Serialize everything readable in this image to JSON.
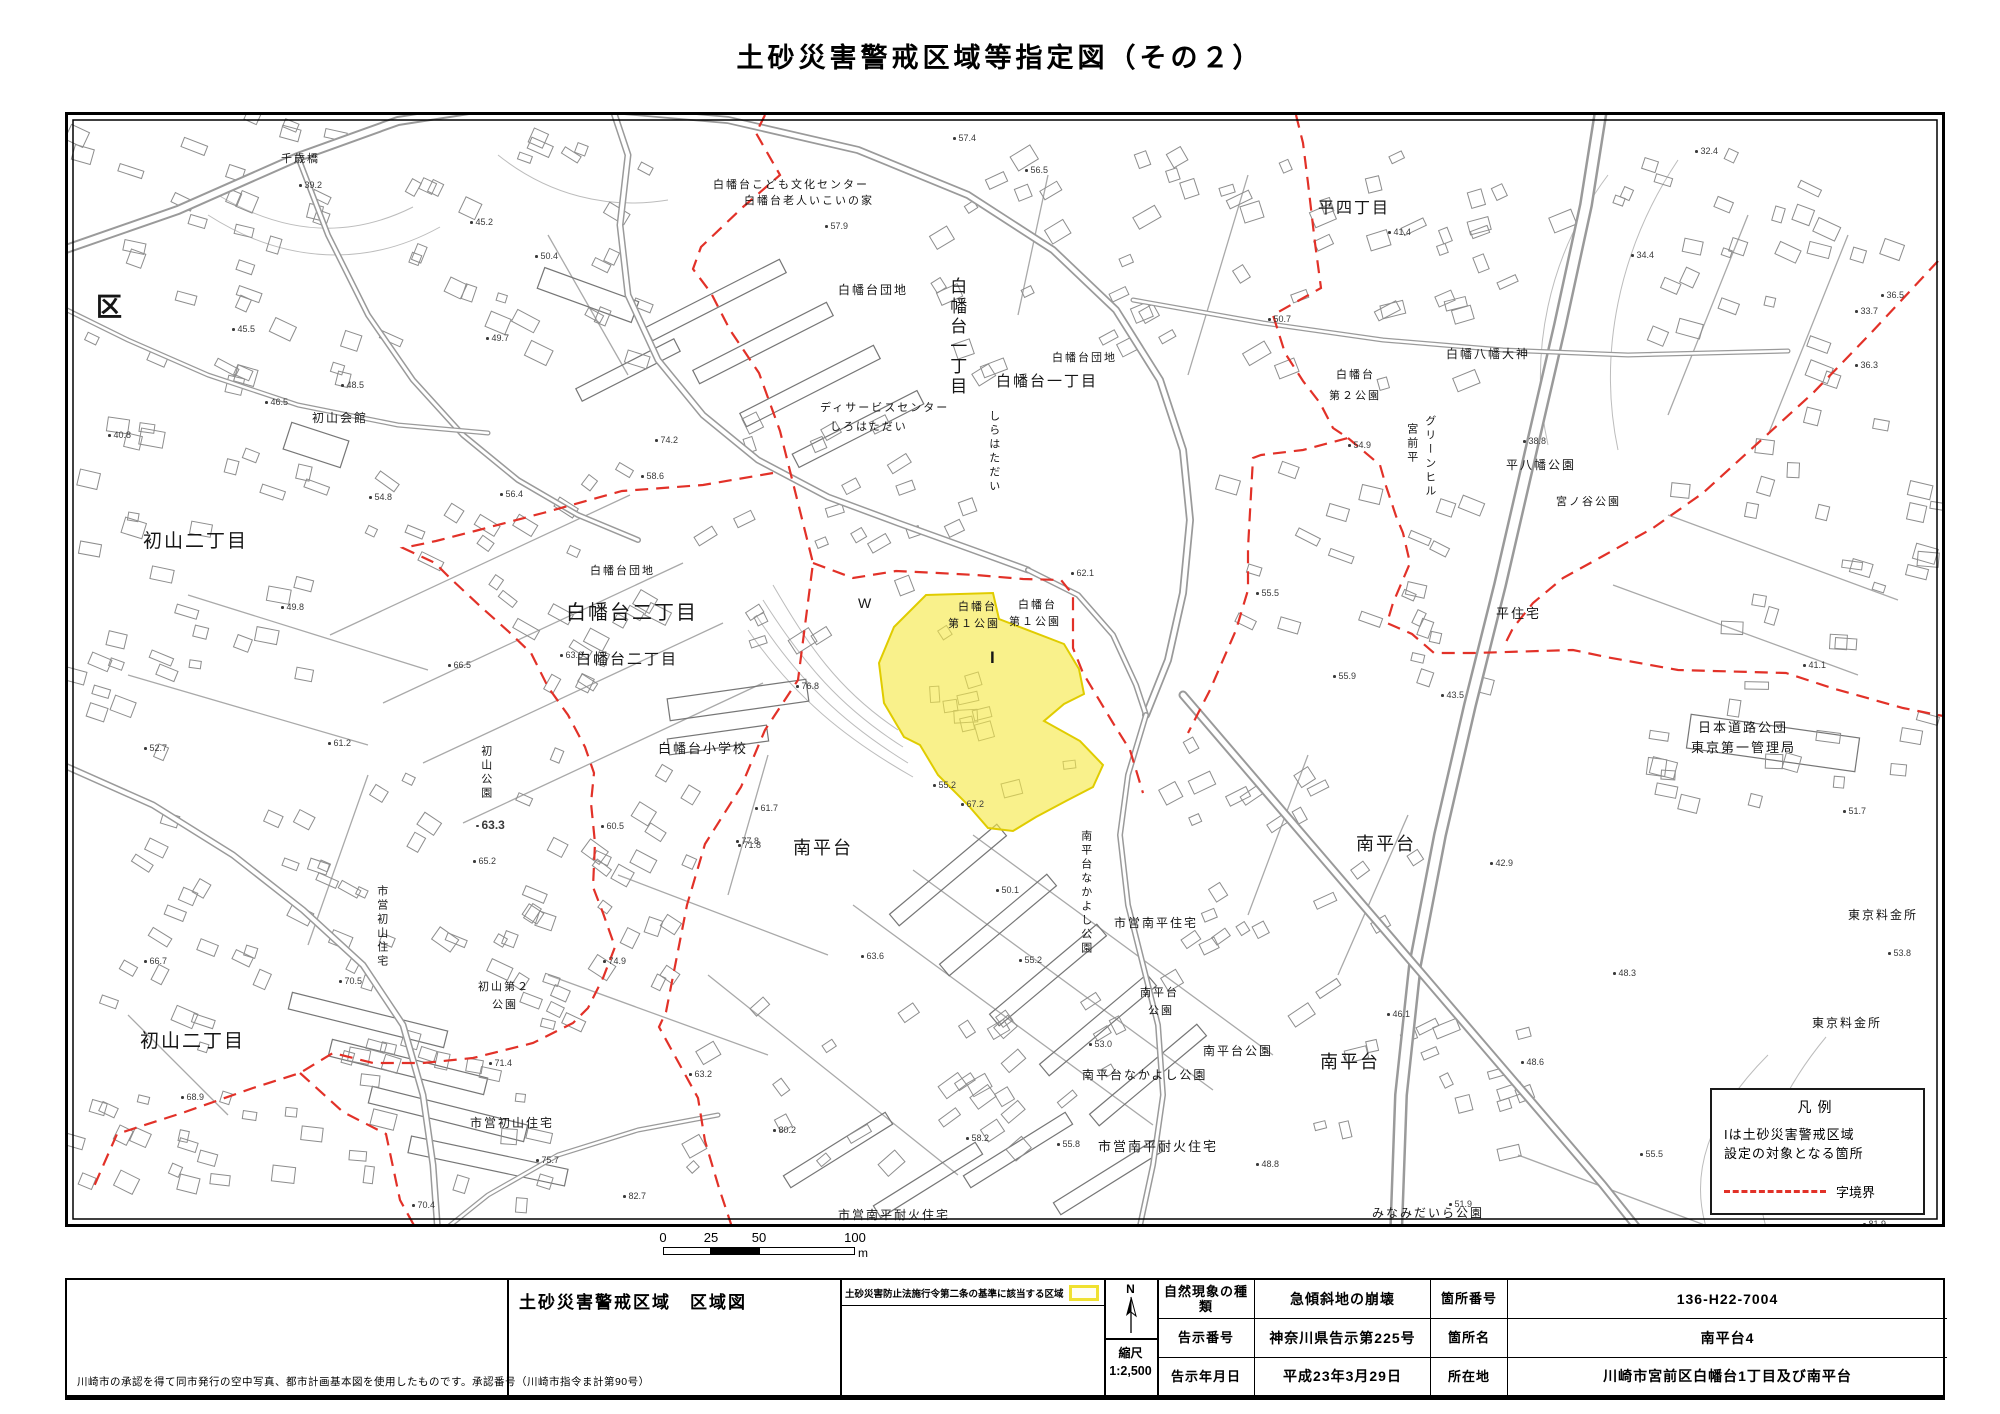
{
  "title": "土砂災害警戒区域等指定図（その２）",
  "colors": {
    "boundary": "#e23128",
    "zone_fill": "#f6e943",
    "zone_edge": "#e0cc00",
    "road_line": "#9a9a9a",
    "building_line": "#8d8d8d"
  },
  "legend": {
    "title": "凡例",
    "line1": "Iは土砂災害警戒区域",
    "line2": "設定の対象となる箇所",
    "boundary_label": "字境界"
  },
  "scale_bar": {
    "unit": "m",
    "ticks": [
      {
        "t": "0",
        "p": 0
      },
      {
        "t": "25",
        "p": 48
      },
      {
        "t": "50",
        "p": 96
      },
      {
        "t": "100",
        "p": 192
      }
    ],
    "segments": [
      {
        "p": 0,
        "w": 48,
        "c": "#ffffff"
      },
      {
        "p": 48,
        "w": 48,
        "c": "#000000"
      },
      {
        "p": 96,
        "w": 96,
        "c": "#ffffff"
      }
    ]
  },
  "title_block": {
    "note": "川崎市の承認を得て同市発行の空中写真、都市計画基本図を使用したものです。承認番号（川崎市指令ま計第90号）",
    "sheet_title": "土砂災害警戒区域　区域図",
    "zone_note": "土砂災害防止法施行令第二条の基準に該当する区域",
    "north_label": "N",
    "scale_label": "縮尺",
    "scale_value": "1:2,500",
    "rows": [
      {
        "k1": "自然現象の種類",
        "v1": "急傾斜地の崩壊",
        "k2": "箇所番号",
        "v2": "136-H22-7004"
      },
      {
        "k1": "告示番号",
        "v1": "神奈川県告示第225号",
        "k2": "箇所名",
        "v2": "南平台4"
      },
      {
        "k1": "告示年月日",
        "v1": "平成23年3月29日",
        "k2": "所在地",
        "v2": "川崎市宮前区白幡台1丁目及び南平台"
      }
    ]
  },
  "map": {
    "labels": [
      {
        "t": "区",
        "x": 28,
        "y": 176,
        "s": 26,
        "b": 1
      },
      {
        "t": "初山二丁目",
        "x": 75,
        "y": 415,
        "s": 19
      },
      {
        "t": "初山二丁目",
        "x": 72,
        "y": 915,
        "s": 19
      },
      {
        "t": "白幡台二丁目",
        "x": 498,
        "y": 486,
        "s": 20
      },
      {
        "t": "白幡台二丁目",
        "x": 508,
        "y": 536,
        "s": 15
      },
      {
        "t": "南平台",
        "x": 725,
        "y": 722,
        "s": 18
      },
      {
        "t": "南平台",
        "x": 1288,
        "y": 718,
        "s": 18
      },
      {
        "t": "南平台",
        "x": 1252,
        "y": 936,
        "s": 18
      },
      {
        "t": "平四丁目",
        "x": 1250,
        "y": 84,
        "s": 16
      },
      {
        "t": "白幡台一丁目",
        "x": 878,
        "y": 162,
        "s": 17,
        "v": 1
      },
      {
        "t": "白幡台一丁目",
        "x": 928,
        "y": 258,
        "s": 15
      },
      {
        "t": "白幡台こども文化センター",
        "x": 645,
        "y": 64,
        "s": 11
      },
      {
        "t": "白幡台老人いこいの家",
        "x": 676,
        "y": 80,
        "s": 11
      },
      {
        "t": "白幡台団地",
        "x": 770,
        "y": 168,
        "s": 12
      },
      {
        "t": "白幡台団地",
        "x": 522,
        "y": 450,
        "s": 11
      },
      {
        "t": "白幡台団地",
        "x": 984,
        "y": 237,
        "s": 11
      },
      {
        "t": "ディサービスセンター",
        "x": 752,
        "y": 287,
        "s": 11
      },
      {
        "t": "しろはただい",
        "x": 762,
        "y": 306,
        "s": 11
      },
      {
        "t": "しらはただい",
        "x": 918,
        "y": 295,
        "s": 11,
        "v": 1
      },
      {
        "t": "白幡八幡大神",
        "x": 1378,
        "y": 232,
        "s": 12
      },
      {
        "t": "白幡台",
        "x": 1268,
        "y": 254,
        "s": 11
      },
      {
        "t": "第２公園",
        "x": 1261,
        "y": 275,
        "s": 11
      },
      {
        "t": "白幡台",
        "x": 890,
        "y": 486,
        "s": 11
      },
      {
        "t": "第１公園",
        "x": 880,
        "y": 503,
        "s": 11
      },
      {
        "t": "白幡台",
        "x": 950,
        "y": 484,
        "s": 11
      },
      {
        "t": "第１公園",
        "x": 941,
        "y": 501,
        "s": 11
      },
      {
        "t": "白幡台小学校",
        "x": 590,
        "y": 626,
        "s": 13
      },
      {
        "t": "初山会館",
        "x": 244,
        "y": 296,
        "s": 12
      },
      {
        "t": "千歳橋",
        "x": 213,
        "y": 38,
        "s": 11
      },
      {
        "t": "初山公園",
        "x": 410,
        "y": 630,
        "s": 11,
        "v": 1
      },
      {
        "t": "市営初山住宅",
        "x": 306,
        "y": 770,
        "s": 11,
        "v": 1
      },
      {
        "t": "初山第２",
        "x": 410,
        "y": 866,
        "s": 11
      },
      {
        "t": "公園",
        "x": 424,
        "y": 884,
        "s": 11
      },
      {
        "t": "市営初山住宅",
        "x": 402,
        "y": 1001,
        "s": 12
      },
      {
        "t": "市営南平住宅",
        "x": 1046,
        "y": 801,
        "s": 12
      },
      {
        "t": "南平台なかよし公園",
        "x": 1010,
        "y": 715,
        "s": 11,
        "v": 1
      },
      {
        "t": "南平台",
        "x": 1072,
        "y": 872,
        "s": 11
      },
      {
        "t": "公園",
        "x": 1080,
        "y": 890,
        "s": 11
      },
      {
        "t": "南平台公園",
        "x": 1135,
        "y": 929,
        "s": 12
      },
      {
        "t": "南平台なかよし公園",
        "x": 1014,
        "y": 953,
        "s": 12
      },
      {
        "t": "市営南平耐火住宅",
        "x": 1030,
        "y": 1024,
        "s": 13
      },
      {
        "t": "市営南平耐火住宅",
        "x": 770,
        "y": 1093,
        "s": 12
      },
      {
        "t": "日本道路公団",
        "x": 1630,
        "y": 605,
        "s": 13
      },
      {
        "t": "東京第一管理局",
        "x": 1623,
        "y": 625,
        "s": 13
      },
      {
        "t": "東京料金所",
        "x": 1780,
        "y": 793,
        "s": 12
      },
      {
        "t": "東京料金所",
        "x": 1744,
        "y": 901,
        "s": 12
      },
      {
        "t": "みなみだいら公園",
        "x": 1304,
        "y": 1091,
        "s": 12
      },
      {
        "t": "平八幡公園",
        "x": 1438,
        "y": 343,
        "s": 12
      },
      {
        "t": "宮ノ谷公園",
        "x": 1488,
        "y": 381,
        "s": 11
      },
      {
        "t": "平住宅",
        "x": 1428,
        "y": 491,
        "s": 13
      },
      {
        "t": "宮前平",
        "x": 1336,
        "y": 308,
        "s": 11,
        "v": 1
      },
      {
        "t": "グリーンヒル",
        "x": 1354,
        "y": 300,
        "s": 11,
        "v": 1
      },
      {
        "t": "W",
        "x": 790,
        "y": 480,
        "s": 14
      },
      {
        "t": "I",
        "x": 922,
        "y": 532,
        "s": 17,
        "b": 1
      }
    ],
    "spots": [
      {
        "v": "57.4",
        "x": 885,
        "y": 18
      },
      {
        "v": "56.5",
        "x": 957,
        "y": 50
      },
      {
        "v": "57.9",
        "x": 757,
        "y": 106
      },
      {
        "v": "45.2",
        "x": 402,
        "y": 102
      },
      {
        "v": "39.2",
        "x": 231,
        "y": 65
      },
      {
        "v": "50.4",
        "x": 467,
        "y": 136
      },
      {
        "v": "45.5",
        "x": 164,
        "y": 209
      },
      {
        "v": "48.5",
        "x": 273,
        "y": 265
      },
      {
        "v": "49.7",
        "x": 418,
        "y": 218
      },
      {
        "v": "40.8",
        "x": 40,
        "y": 315
      },
      {
        "v": "46.5",
        "x": 197,
        "y": 282
      },
      {
        "v": "54.8",
        "x": 301,
        "y": 377
      },
      {
        "v": "56.4",
        "x": 432,
        "y": 374
      },
      {
        "v": "58.6",
        "x": 573,
        "y": 356
      },
      {
        "v": "41.4",
        "x": 1320,
        "y": 112
      },
      {
        "v": "34.4",
        "x": 1563,
        "y": 135
      },
      {
        "v": "32.4",
        "x": 1627,
        "y": 31
      },
      {
        "v": "33.7",
        "x": 1787,
        "y": 191
      },
      {
        "v": "36.5",
        "x": 1813,
        "y": 175
      },
      {
        "v": "36.3",
        "x": 1787,
        "y": 245
      },
      {
        "v": "50.7",
        "x": 1200,
        "y": 199
      },
      {
        "v": "54.9",
        "x": 1280,
        "y": 325
      },
      {
        "v": "38.8",
        "x": 1455,
        "y": 321
      },
      {
        "v": "55.5",
        "x": 1188,
        "y": 473
      },
      {
        "v": "55.9",
        "x": 1265,
        "y": 556
      },
      {
        "v": "43.5",
        "x": 1373,
        "y": 575
      },
      {
        "v": "41.1",
        "x": 1735,
        "y": 545
      },
      {
        "v": "42.9",
        "x": 1422,
        "y": 743
      },
      {
        "v": "51.7",
        "x": 1775,
        "y": 691
      },
      {
        "v": "48.3",
        "x": 1545,
        "y": 853
      },
      {
        "v": "53.8",
        "x": 1820,
        "y": 833
      },
      {
        "v": "55.5",
        "x": 1572,
        "y": 1034
      },
      {
        "v": "51.9",
        "x": 1381,
        "y": 1084
      },
      {
        "v": "81.9",
        "x": 1795,
        "y": 1104
      },
      {
        "v": "63.6",
        "x": 492,
        "y": 535
      },
      {
        "v": "66.5",
        "x": 380,
        "y": 545
      },
      {
        "v": "63.3",
        "x": 408,
        "y": 703,
        "b": 1
      },
      {
        "v": "65.2",
        "x": 405,
        "y": 741
      },
      {
        "v": "60.5",
        "x": 533,
        "y": 706
      },
      {
        "v": "76.8",
        "x": 728,
        "y": 566
      },
      {
        "v": "77.8",
        "x": 668,
        "y": 721
      },
      {
        "v": "74.2",
        "x": 587,
        "y": 320
      },
      {
        "v": "74.9",
        "x": 535,
        "y": 841
      },
      {
        "v": "70.5",
        "x": 271,
        "y": 861
      },
      {
        "v": "71.4",
        "x": 421,
        "y": 943
      },
      {
        "v": "68.9",
        "x": 113,
        "y": 977
      },
      {
        "v": "75.7",
        "x": 468,
        "y": 1040
      },
      {
        "v": "70.4",
        "x": 344,
        "y": 1085
      },
      {
        "v": "66.7",
        "x": 76,
        "y": 841
      },
      {
        "v": "52.7",
        "x": 76,
        "y": 628
      },
      {
        "v": "61.2",
        "x": 260,
        "y": 623
      },
      {
        "v": "49.8",
        "x": 213,
        "y": 487
      },
      {
        "v": "67.2",
        "x": 893,
        "y": 684
      },
      {
        "v": "71.8",
        "x": 670,
        "y": 725
      },
      {
        "v": "63.6",
        "x": 793,
        "y": 836
      },
      {
        "v": "55.2",
        "x": 951,
        "y": 840
      },
      {
        "v": "53.0",
        "x": 1021,
        "y": 924
      },
      {
        "v": "63.2",
        "x": 621,
        "y": 954
      },
      {
        "v": "58.2",
        "x": 898,
        "y": 1018
      },
      {
        "v": "55.8",
        "x": 989,
        "y": 1024
      },
      {
        "v": "48.8",
        "x": 1188,
        "y": 1044
      },
      {
        "v": "82.7",
        "x": 555,
        "y": 1076
      },
      {
        "v": "80.2",
        "x": 705,
        "y": 1010
      },
      {
        "v": "62.1",
        "x": 1003,
        "y": 453
      },
      {
        "v": "55.2",
        "x": 865,
        "y": 665
      },
      {
        "v": "61.7",
        "x": 687,
        "y": 688
      },
      {
        "v": "50.1",
        "x": 928,
        "y": 770
      },
      {
        "v": "46.1",
        "x": 1319,
        "y": 894
      },
      {
        "v": "48.6",
        "x": 1453,
        "y": 942
      }
    ]
  }
}
